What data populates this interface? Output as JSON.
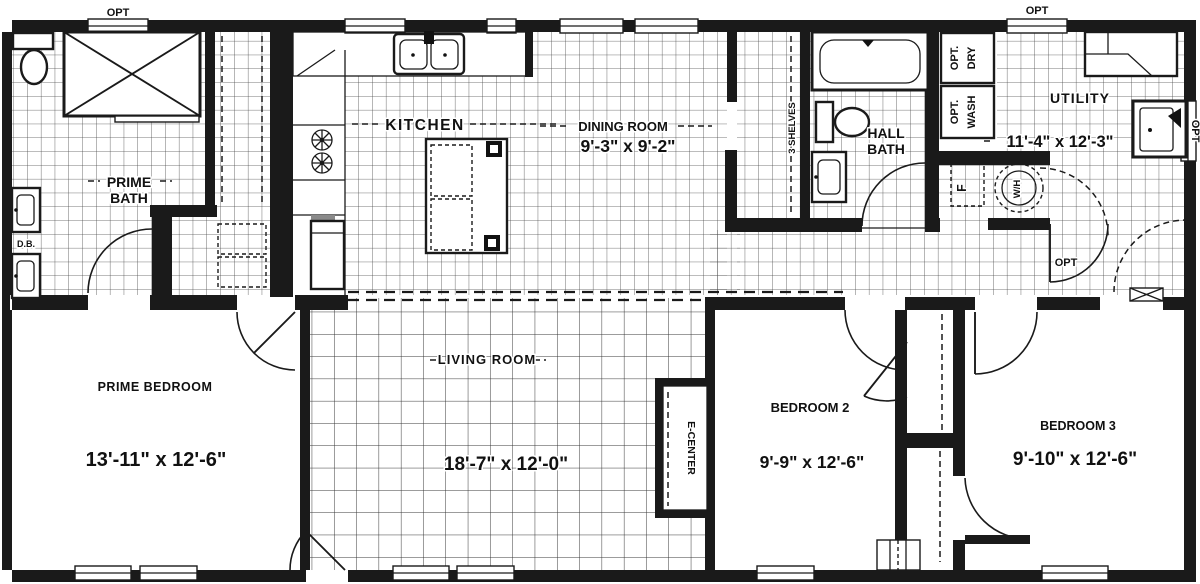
{
  "rooms": {
    "prime_bath": {
      "line1": "PRIME",
      "line2": "BATH"
    },
    "kitchen": {
      "name": "KITCHEN"
    },
    "dining_room": {
      "name": "DINING ROOM",
      "dims": "9'-3\" x 9'-2\""
    },
    "hall_bath": {
      "line1": "HALL",
      "line2": "BATH"
    },
    "utility": {
      "name": "UTILITY",
      "dims": "11'-4\" x 12'-3\""
    },
    "prime_bedroom": {
      "name": "PRIME BEDROOM",
      "dims": "13'-11\" x 12'-6\""
    },
    "living_room": {
      "name": "LIVING ROOM",
      "dims": "18'-7\" x 12'-0\""
    },
    "bedroom2": {
      "name": "BEDROOM 2",
      "dims": "9'-9\" x 12'-6\""
    },
    "bedroom3": {
      "name": "BEDROOM 3",
      "dims": "9'-10\" x 12'-6\""
    }
  },
  "labels": {
    "opt": "OPT",
    "opt_dot": "OPT.",
    "dry": "DRY",
    "wash": "WASH",
    "shelves": "3 SHELVES",
    "db": "D.B.",
    "e_center": "E-CENTER",
    "water_heater": "W/H",
    "furnace": "F"
  },
  "colors": {
    "wall": "#1a1a1a",
    "background": "#ffffff",
    "tile_line": "#4a4a4a"
  }
}
